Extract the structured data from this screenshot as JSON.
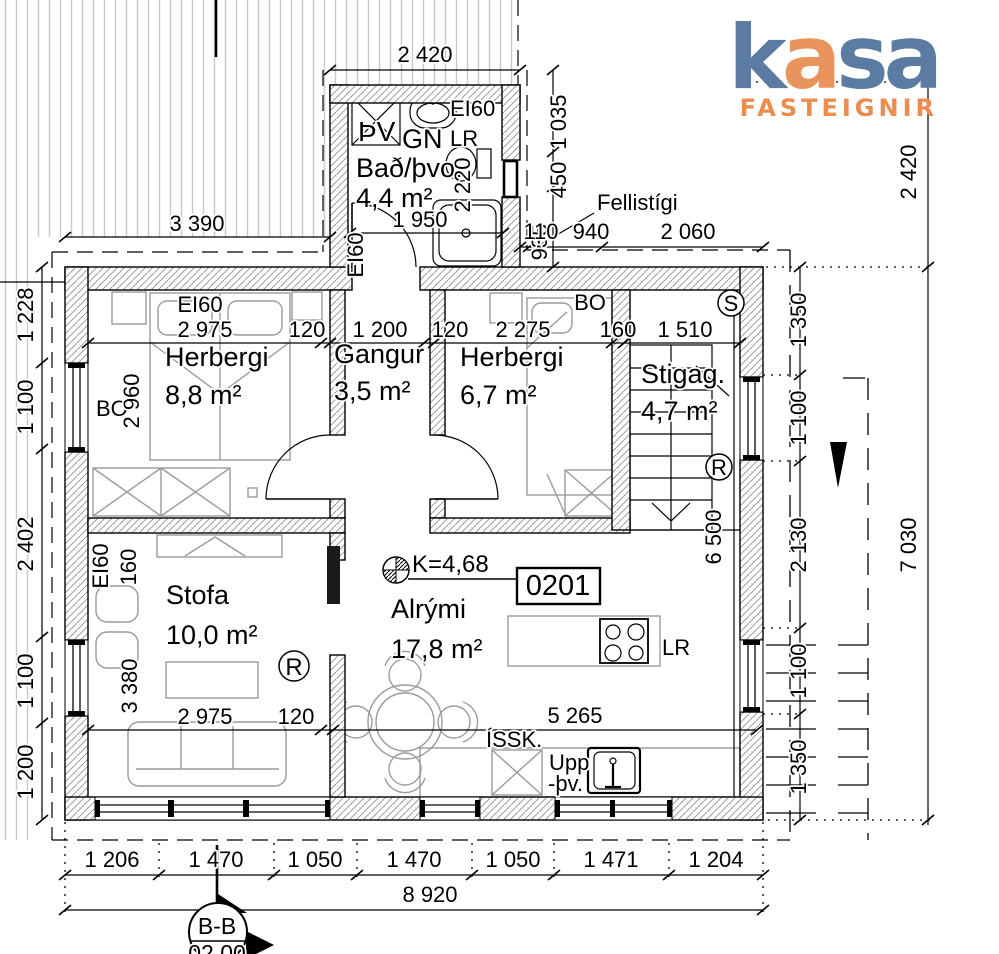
{
  "logo": {
    "l1": "k",
    "l2": "a",
    "l3": "s",
    "l4": "a",
    "subtitle": "FASTEIGNIR"
  },
  "colors": {
    "logo_blue": "#5b7ba2",
    "logo_orange": "#e8945c",
    "sub_orange": "#ea8d4f"
  },
  "unit": {
    "number": "0201"
  },
  "level": {
    "mark": "K=4,68"
  },
  "section": {
    "name": "B-B",
    "sheet": "02 00"
  },
  "rooms": {
    "bath": {
      "name": "Bað/þvo.",
      "area": "4,4 m²"
    },
    "bedroom1": {
      "name": "Herbergi",
      "area": "8,8 m²"
    },
    "hall": {
      "name": "Gangur",
      "area": "3,5 m²"
    },
    "bedroom2": {
      "name": "Herbergi",
      "area": "6,7 m²"
    },
    "stairwell": {
      "name": "Stigag.",
      "area": "4,7 m²"
    },
    "living": {
      "name": "Stofa",
      "area": "10,0 m²"
    },
    "openplan": {
      "name": "Alrými",
      "area": "17,8 m²"
    }
  },
  "marks": {
    "ei60": "EI60",
    "bo": "BO",
    "s": "S",
    "r": "R",
    "lr": "LR",
    "pv": "ÞV",
    "gn": "GN",
    "issk": "ÍSSK.",
    "upp": "Upp",
    "thv": "-þv.",
    "fellistigi": "Fellistígi"
  },
  "dims": {
    "d110": "110",
    "d120": "120",
    "d160": "160",
    "d450": "450",
    "d935": "935",
    "d940": "940",
    "d1035": "1 035",
    "d1050": "1 050",
    "d1100": "1 100",
    "d1200": "1 200",
    "d1204": "1 204",
    "d1206": "1 206",
    "d1228": "1 228",
    "d1350": "1 350",
    "d1470": "1 470",
    "d1471": "1 471",
    "d1510": "1 510",
    "d1950": "1 950",
    "d2060": "2 060",
    "d2130": "2 130",
    "d2220": "2 220",
    "d2275": "2 275",
    "d2402": "2 402",
    "d2420": "2 420",
    "d2960": "2 960",
    "d2975": "2 975",
    "d3380": "3 380",
    "d3390": "3 390",
    "d5265": "5 265",
    "d6500": "6 500",
    "d7030": "7 030",
    "d8920": "8 920"
  }
}
